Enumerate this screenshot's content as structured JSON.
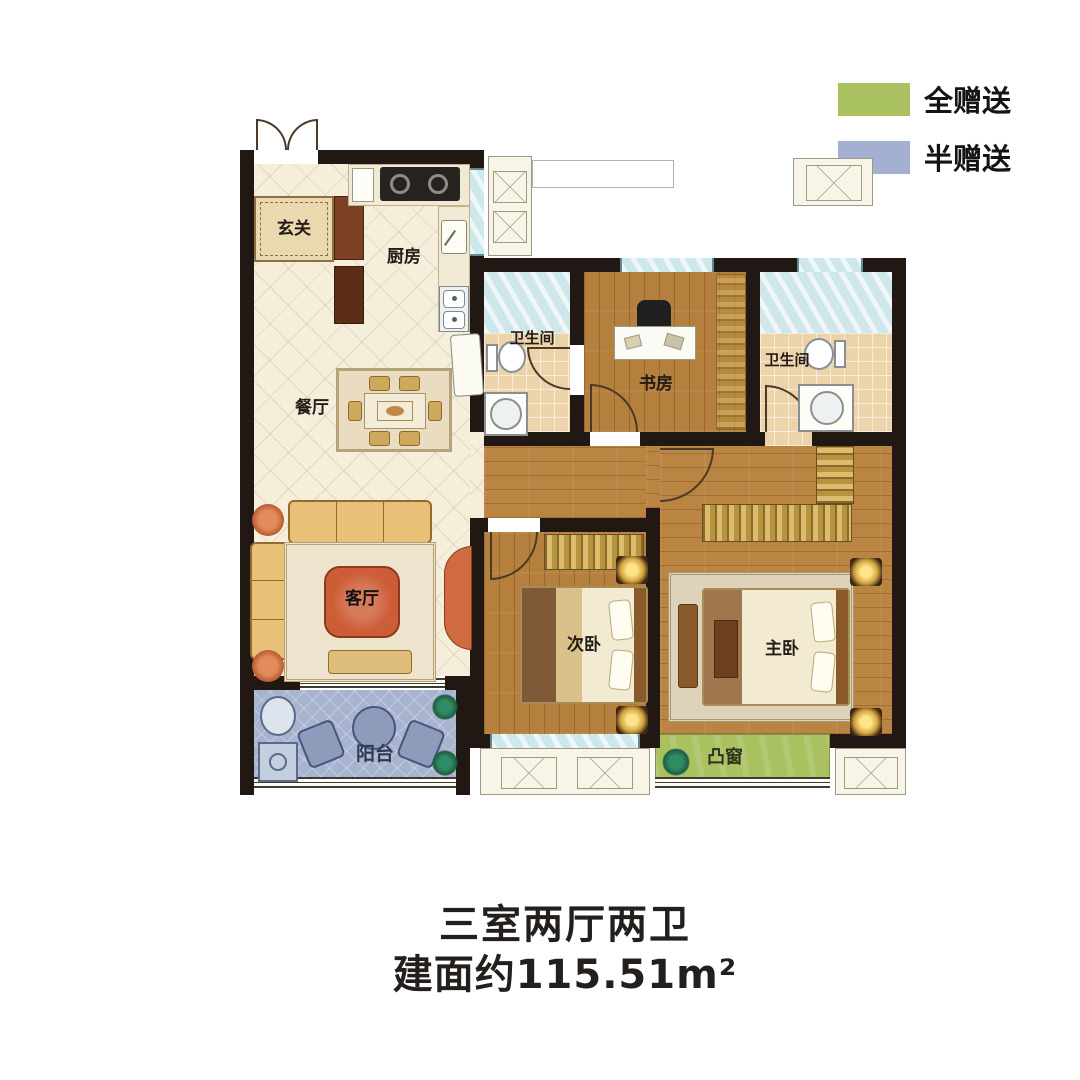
{
  "legend": {
    "items": [
      {
        "label": "全赠送",
        "color": "#a9c161",
        "meaning": "fully-gifted-area"
      },
      {
        "label": "半赠送",
        "color": "#a3b0d2",
        "meaning": "half-gifted-area"
      }
    ]
  },
  "rooms": {
    "foyer": {
      "label": "玄关"
    },
    "kitchen": {
      "label": "厨房"
    },
    "dining": {
      "label": "餐厅"
    },
    "living": {
      "label": "客厅"
    },
    "balcony": {
      "label": "阳台"
    },
    "bath_main": {
      "label": "卫生间"
    },
    "bath_master": {
      "label": "卫生间"
    },
    "study": {
      "label": "书房"
    },
    "bedroom_second": {
      "label": "次卧"
    },
    "bedroom_master": {
      "label": "主卧"
    },
    "bay_window": {
      "label": "凸窗"
    }
  },
  "title": {
    "line1": "三室两厅两卫",
    "line2": "建面约115.51m²"
  },
  "colors": {
    "full_gift": "#a9c161",
    "half_gift": "#a3b0d2",
    "wall": "#211813"
  }
}
